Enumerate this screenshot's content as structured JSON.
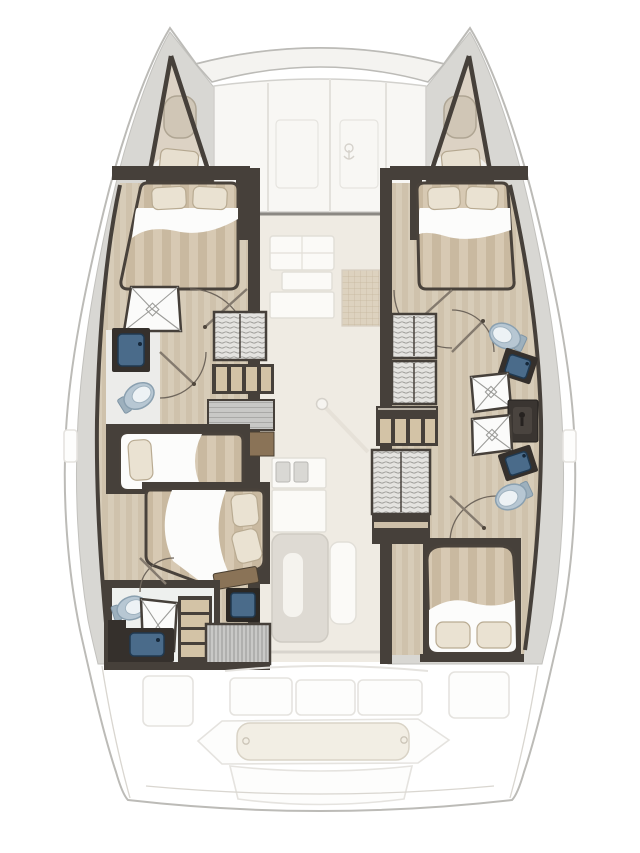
{
  "diagram": {
    "kind": "catamaran-yacht-interior-floor-plan",
    "view": "top-down",
    "orientation": "bow-up",
    "hulls": 2
  },
  "areas": [
    "port-bow-forepeak",
    "starboard-bow-forepeak",
    "foredeck-sunpad",
    "port-forward-cabin",
    "starboard-forward-cabin",
    "port-forward-bathroom",
    "port-companionway-stairs",
    "port-single-berth",
    "port-aft-cabin",
    "port-aft-bathroom",
    "starboard-corridor",
    "starboard-forward-bathroom",
    "starboard-aft-bathroom",
    "starboard-companionway-stairs",
    "starboard-aft-cabin",
    "saloon-galley",
    "saloon-nav-seat",
    "saloon-table",
    "mast-post",
    "cockpit-seats",
    "cockpit-aft-bench",
    "swim-platform"
  ],
  "icons": [
    "toilet-icon",
    "sink-icon",
    "shower-pan-icon",
    "bed-icon",
    "pillow-icon",
    "wardrobe-icon",
    "stairs-icon",
    "door-swing-icon",
    "hatch-icon",
    "anchor-logo-icon"
  ],
  "palette": {
    "background": "#ffffff",
    "hull_outline": "#bcbbb7",
    "deck_gray": "#d8d7d3",
    "deck_gray_dark": "#c2c1bd",
    "wall_dark": "#46403a",
    "wood_floor": "#cfc2ac",
    "wood_floor_light": "#d7ccb8",
    "mattress": "#d7c9b3",
    "mattress_stripe": "#c9b9a0",
    "pillow": "#eae2d2",
    "pillow_edge": "#b9ab92",
    "sheet_white": "#fcfcfb",
    "shower_line": "#9c9c99",
    "toilet_fill": "#b7c7d3",
    "toilet_rim": "#8aa0b0",
    "sink_basin": "#4a6b8a",
    "sink_dark": "#203950",
    "counter_dark": "#35302c",
    "locker_line": "#93928e",
    "step_tread": "#d3c3a6",
    "companionway": "#c8c8c6",
    "companionway_line": "#a9a9a7",
    "saloon_floor": "#efebe3",
    "saloon_furniture": "#fbfaf7",
    "saloon_outline": "#e2dfd8",
    "grid_mat": "#ddd2bf",
    "grid_line": "#c6b69e",
    "cockpit_floor": "#fdfdfc",
    "cockpit_outline": "#e5e3df",
    "cushion_aft": "#f2eee4",
    "cushion_aft_edge": "#d9d3c6",
    "shelf_brown": "#8a7357",
    "door_line": "#6f665c"
  }
}
